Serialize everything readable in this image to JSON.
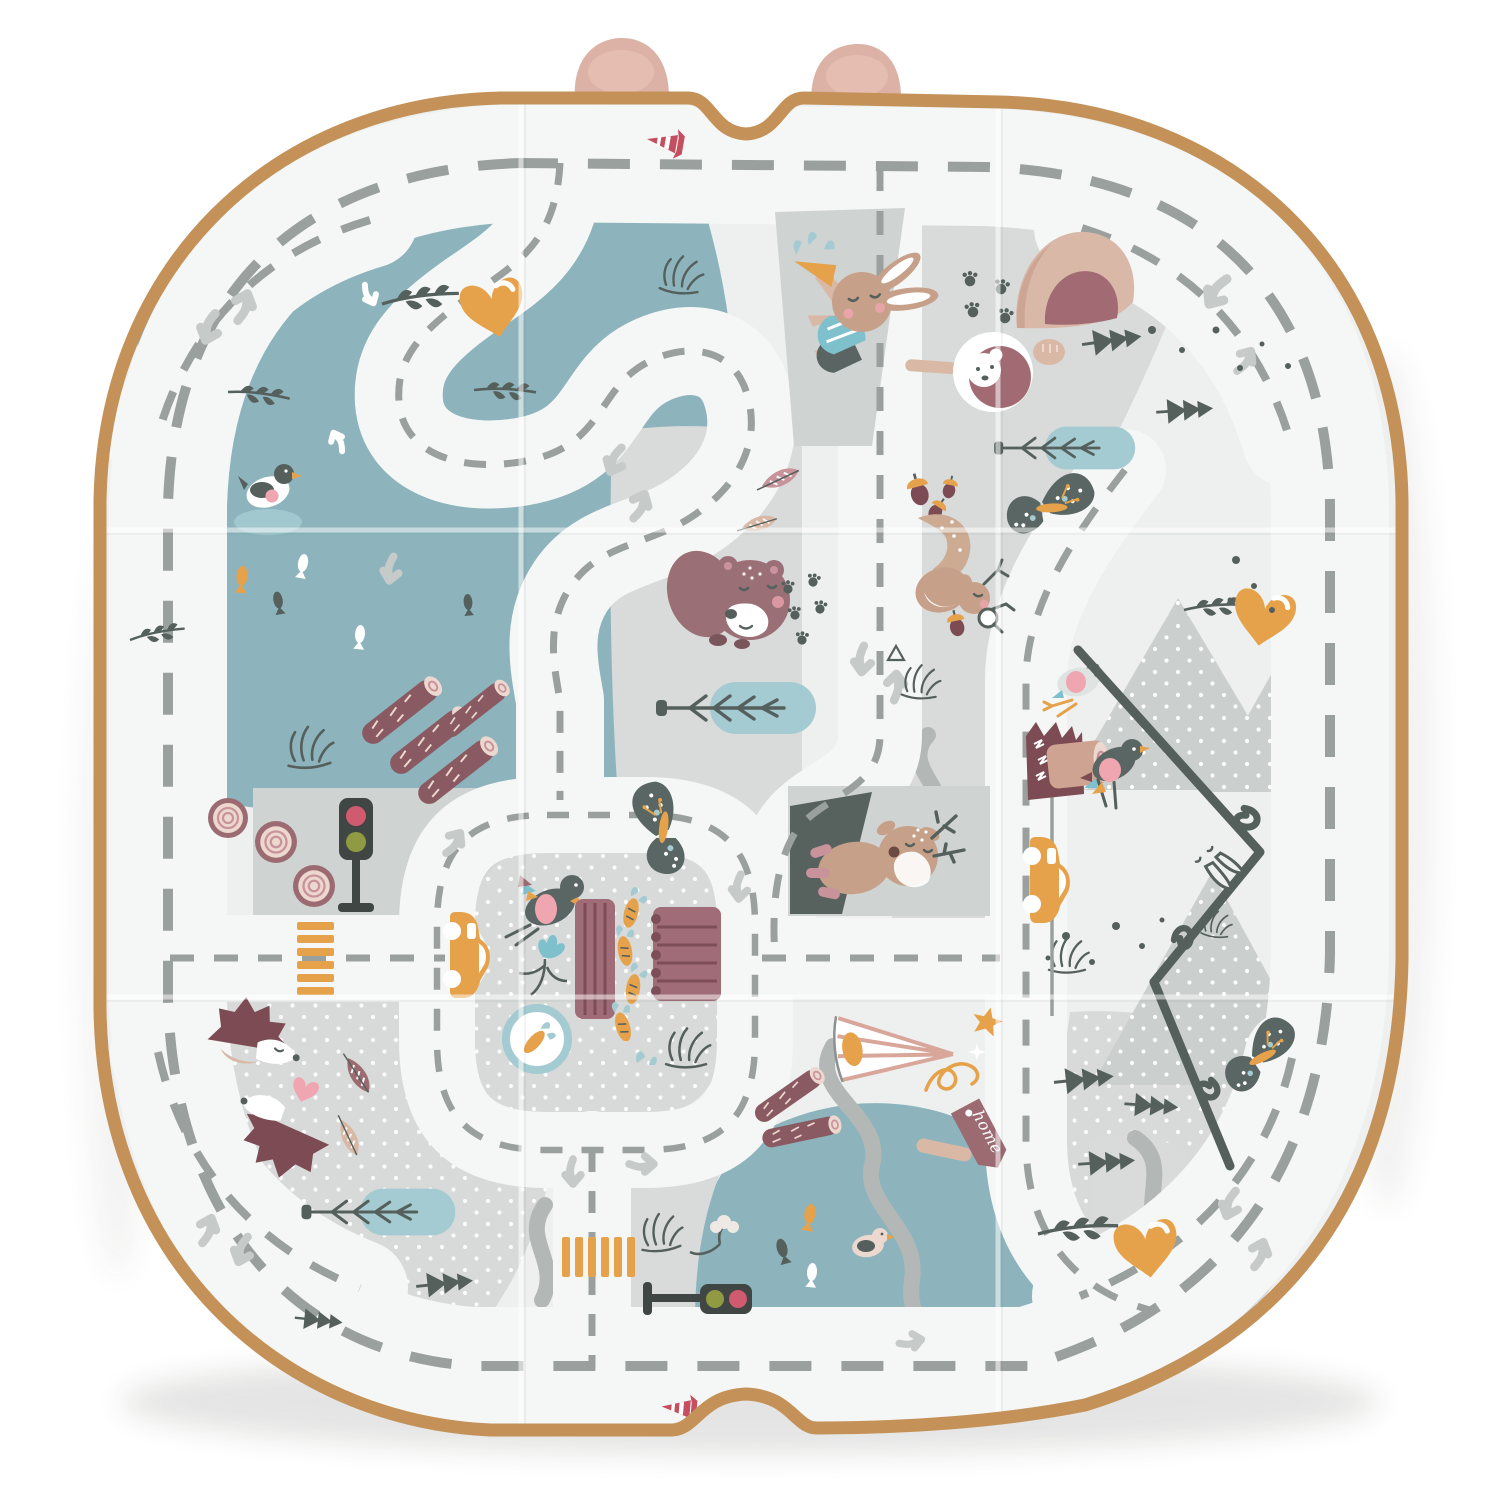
{
  "product": {
    "kind": "foldable baby play mat, top view",
    "theme": "woodland road-map with animals"
  },
  "labels": {
    "home_sign": "home"
  },
  "palette": {
    "page": "#ffffff",
    "borderTan": "#c49258",
    "earPink": "#dcb2a6",
    "earPinkLight": "#ecc9ba",
    "matBase": "#eef0ef",
    "road": "#f5f7f6",
    "panel": "#d8dbda",
    "panel2": "#cfd3d2",
    "dotted": "#d7dad9",
    "mountain": "#cbcfce",
    "lake": "#8db4bd",
    "pond": "#a4cbd1",
    "dash": "#9aa09e",
    "arrow": "#c6cac9",
    "dark": "#55605d",
    "river": "#b3b8b7",
    "orange": "#e6a24b",
    "mauve": "#9c6b72",
    "mauveDark": "#7c4b53",
    "bedMauve": "#a06c77",
    "plumLight": "#c8939b",
    "cream": "#ecd8cf",
    "tanAnimal": "#c7a089",
    "tanLight": "#d9b9a5",
    "bearBrown": "#9a7076",
    "pink": "#efa6b1",
    "pinkSoft": "#f3c3ca",
    "red": "#c54f5e",
    "teal": "#7fc0cd",
    "olive": "#8f9a42",
    "slate": "#5a6663",
    "birdGray": "#dfe3e2",
    "logBrown": "#8a5a62",
    "logLight": "#cfa391",
    "caveTan": "#d9b8a8",
    "caveInner": "#a26b74",
    "trafficDark": "#3f4643",
    "redLight": "#d05a6e",
    "tentRay": "#d8a79a",
    "white": "#ffffff"
  },
  "scene": {
    "elements": [
      "tan-edge-border",
      "fabric-ear-left",
      "fabric-ear-right",
      "fold-lines",
      "outer-ring-road",
      "serpentine-lake-road",
      "center-loop-road",
      "vertical-road",
      "right-road",
      "top-left-lake",
      "bottom-lake",
      "garden-plot",
      "mountains",
      "mountain-trail",
      "bear",
      "bunny-with-carrot",
      "deer",
      "squirrel",
      "hedgehogs-kissing",
      "duck",
      "birds",
      "fish",
      "bear-in-hole",
      "den-cave",
      "log-signpost",
      "tree-stumps",
      "log-piles",
      "traffic-light-vertical",
      "traffic-light-horizontal",
      "crosswalk-left",
      "crosswalk-bottom",
      "traffic-cone-top",
      "traffic-cone-bottom",
      "car-left",
      "car-right",
      "orange-hearts",
      "pink-heart",
      "pine-trees",
      "branch-ponds",
      "twigs",
      "feather-leaves",
      "acorns",
      "butterflies",
      "paw-prints",
      "tent",
      "home-sign",
      "stars",
      "orange-squiggle",
      "grass-sketches"
    ]
  }
}
